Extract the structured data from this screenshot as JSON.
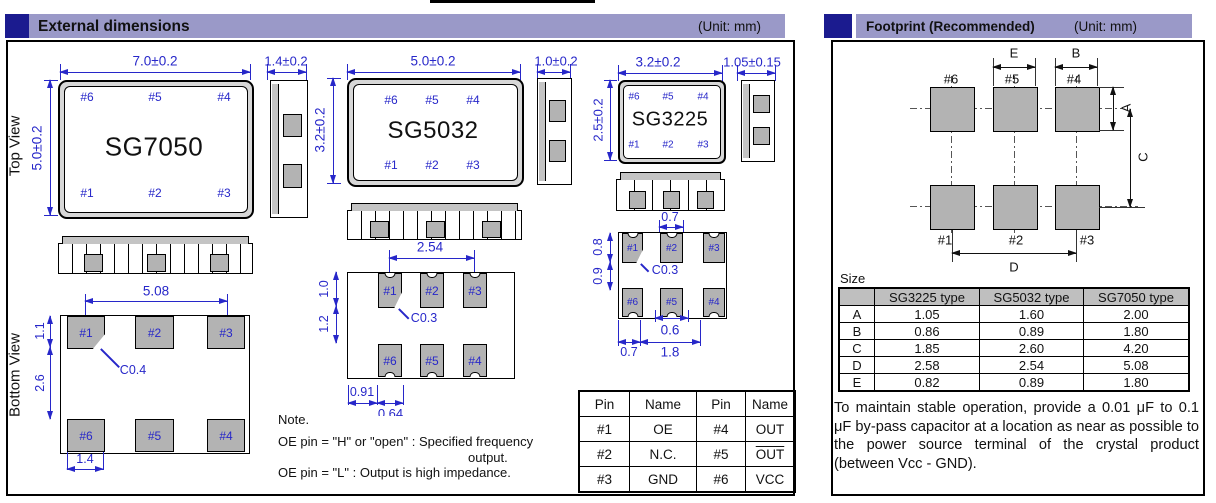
{
  "headers": {
    "left": {
      "title": "External dimensions",
      "unit": "(Unit: mm)"
    },
    "right": {
      "title": "Footprint (Recommended)",
      "unit": "(Unit: mm)"
    }
  },
  "sg7050": {
    "name": "SG7050",
    "top_view_label": "Top View",
    "bottom_view_label": "Bottom View",
    "dim_width": "7.0±0.2",
    "dim_height": "5.0±0.2",
    "dim_side": "1.4±0.2",
    "pins_top": [
      "#6",
      "#5",
      "#4"
    ],
    "pins_bottom": [
      "#1",
      "#2",
      "#3"
    ],
    "bottom": {
      "dim_pitch": "5.08",
      "dim_v1": "1.1",
      "dim_v2": "2.6",
      "chamfer": "C0.4",
      "dim_pad": "1.4",
      "row1": [
        "#1",
        "#2",
        "#3"
      ],
      "row2": [
        "#6",
        "#5",
        "#4"
      ]
    }
  },
  "sg5032": {
    "name": "SG5032",
    "dim_width": "5.0±0.2",
    "dim_height": "3.2±0.2",
    "dim_side": "1.0±0.2",
    "pins_top": [
      "#6",
      "#5",
      "#4"
    ],
    "pins_bottom": [
      "#1",
      "#2",
      "#3"
    ],
    "bottom": {
      "dim_pitch": "2.54",
      "dim_v1": "1.0",
      "dim_v2": "1.2",
      "chamfer": "C0.3",
      "dim_b1": "0.91",
      "dim_b2": "0.64",
      "row1": [
        "#1",
        "#2",
        "#3"
      ],
      "row2": [
        "#6",
        "#5",
        "#4"
      ]
    }
  },
  "sg3225": {
    "name": "SG3225",
    "dim_width": "3.2±0.2",
    "dim_height": "2.5±0.2",
    "dim_side": "1.05±0.15",
    "pins_top": [
      "#6",
      "#5",
      "#4"
    ],
    "pins_bottom": [
      "#1",
      "#2",
      "#3"
    ],
    "bottom": {
      "dim_top": "0.7",
      "dim_v1": "0.8",
      "dim_v2": "0.9",
      "chamfer": "C0.3",
      "dim_mid": "0.6",
      "dim_b1": "0.7",
      "dim_b2": "1.8",
      "row1": [
        "#1",
        "#2",
        "#3"
      ],
      "row2": [
        "#6",
        "#5",
        "#4"
      ]
    }
  },
  "pin_table": {
    "headers": [
      "Pin",
      "Name",
      "Pin",
      "Name"
    ],
    "rows": [
      [
        "#1",
        "OE",
        "#4",
        "OUT"
      ],
      [
        "#2",
        "N.C.",
        "#5",
        "OUT"
      ],
      [
        "#3",
        "GND",
        "#6",
        "VCC"
      ]
    ]
  },
  "note": {
    "title": "Note.",
    "line1": "OE pin = \"H\" or \"open\" : Specified frequency",
    "line2": "output.",
    "line3": "OE pin = \"L\" : Output is high impedance."
  },
  "footprint": {
    "labels_top": [
      "#6",
      "#5",
      "#4"
    ],
    "labels_bottom": [
      "#1",
      "#2",
      "#3"
    ],
    "dim_e": "E",
    "dim_b": "B",
    "dim_a": "A",
    "dim_c": "C",
    "dim_d": "D",
    "size_label": "Size",
    "table": {
      "col_headers": [
        "SG3225 type",
        "SG5032 type",
        "SG7050 type"
      ],
      "rows": [
        [
          "A",
          "1.05",
          "1.60",
          "2.00"
        ],
        [
          "B",
          "0.86",
          "0.89",
          "1.80"
        ],
        [
          "C",
          "1.85",
          "2.60",
          "4.20"
        ],
        [
          "D",
          "2.58",
          "2.54",
          "5.08"
        ],
        [
          "E",
          "0.82",
          "0.89",
          "1.80"
        ]
      ]
    },
    "note": "To maintain stable operation, provide a 0.01 μF to 0.1 μF by-pass capacitor at a location as near as possible to the power source terminal of the crystal product (between Vcc - GND)."
  },
  "colors": {
    "accent_navy": "#1b1b8f",
    "bar_lavender": "#9a99c8",
    "dim_blue": "#2727c9",
    "pad_gray": "#b3b3b3"
  }
}
